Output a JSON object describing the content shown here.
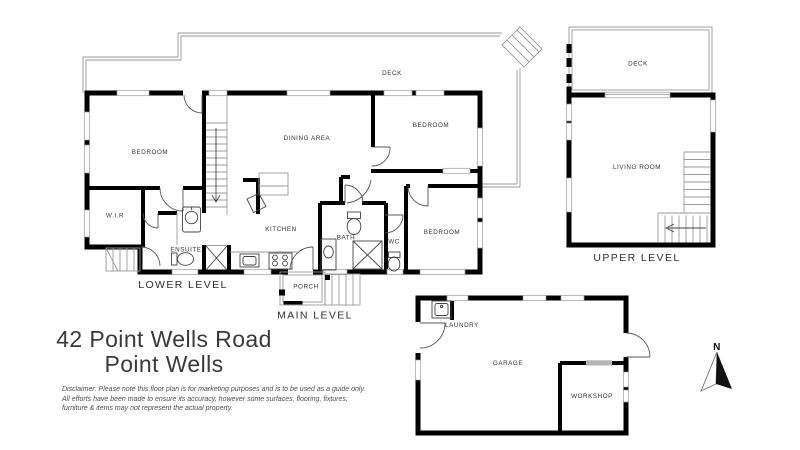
{
  "title": {
    "line1": "42 Point Wells Road",
    "line2": "Point Wells"
  },
  "disclaimer": {
    "line1": "Disclaimer: Please note this floor plan is for marketing purposes and is to be used as a guide only.",
    "line2": "All efforts have been made to ensure its accuracy, however some surfaces, flooring, fixtures,",
    "line3": "furniture & items may not represent the actual property."
  },
  "levels": {
    "lower_label": "LOWER LEVEL",
    "main_label": "MAIN LEVEL",
    "upper_label": "UPPER LEVEL"
  },
  "rooms": {
    "bedroom_lower": "BEDROOM",
    "wir": "W.I.R",
    "ensuite": "ENSUITE",
    "dining_area": "DINING AREA",
    "kitchen": "KITCHEN",
    "bath": "BATH",
    "wc": "WC",
    "bedroom_main_top": "BEDROOM",
    "bedroom_main_right": "BEDROOM",
    "deck_main": "DECK",
    "porch": "PORCH",
    "deck_upper": "DECK",
    "living_room": "LIVING ROOM",
    "laundry": "LAUNDRY",
    "garage": "GARAGE",
    "workshop": "WORKSHOP"
  },
  "compass": {
    "north_label": "N"
  },
  "colors": {
    "wall": "#000000",
    "deck_line": "#9a9a9a",
    "fixture": "#444444",
    "label_text": "#333333",
    "wardrobe_grey": "#b5b5b5",
    "background": "#ffffff"
  }
}
